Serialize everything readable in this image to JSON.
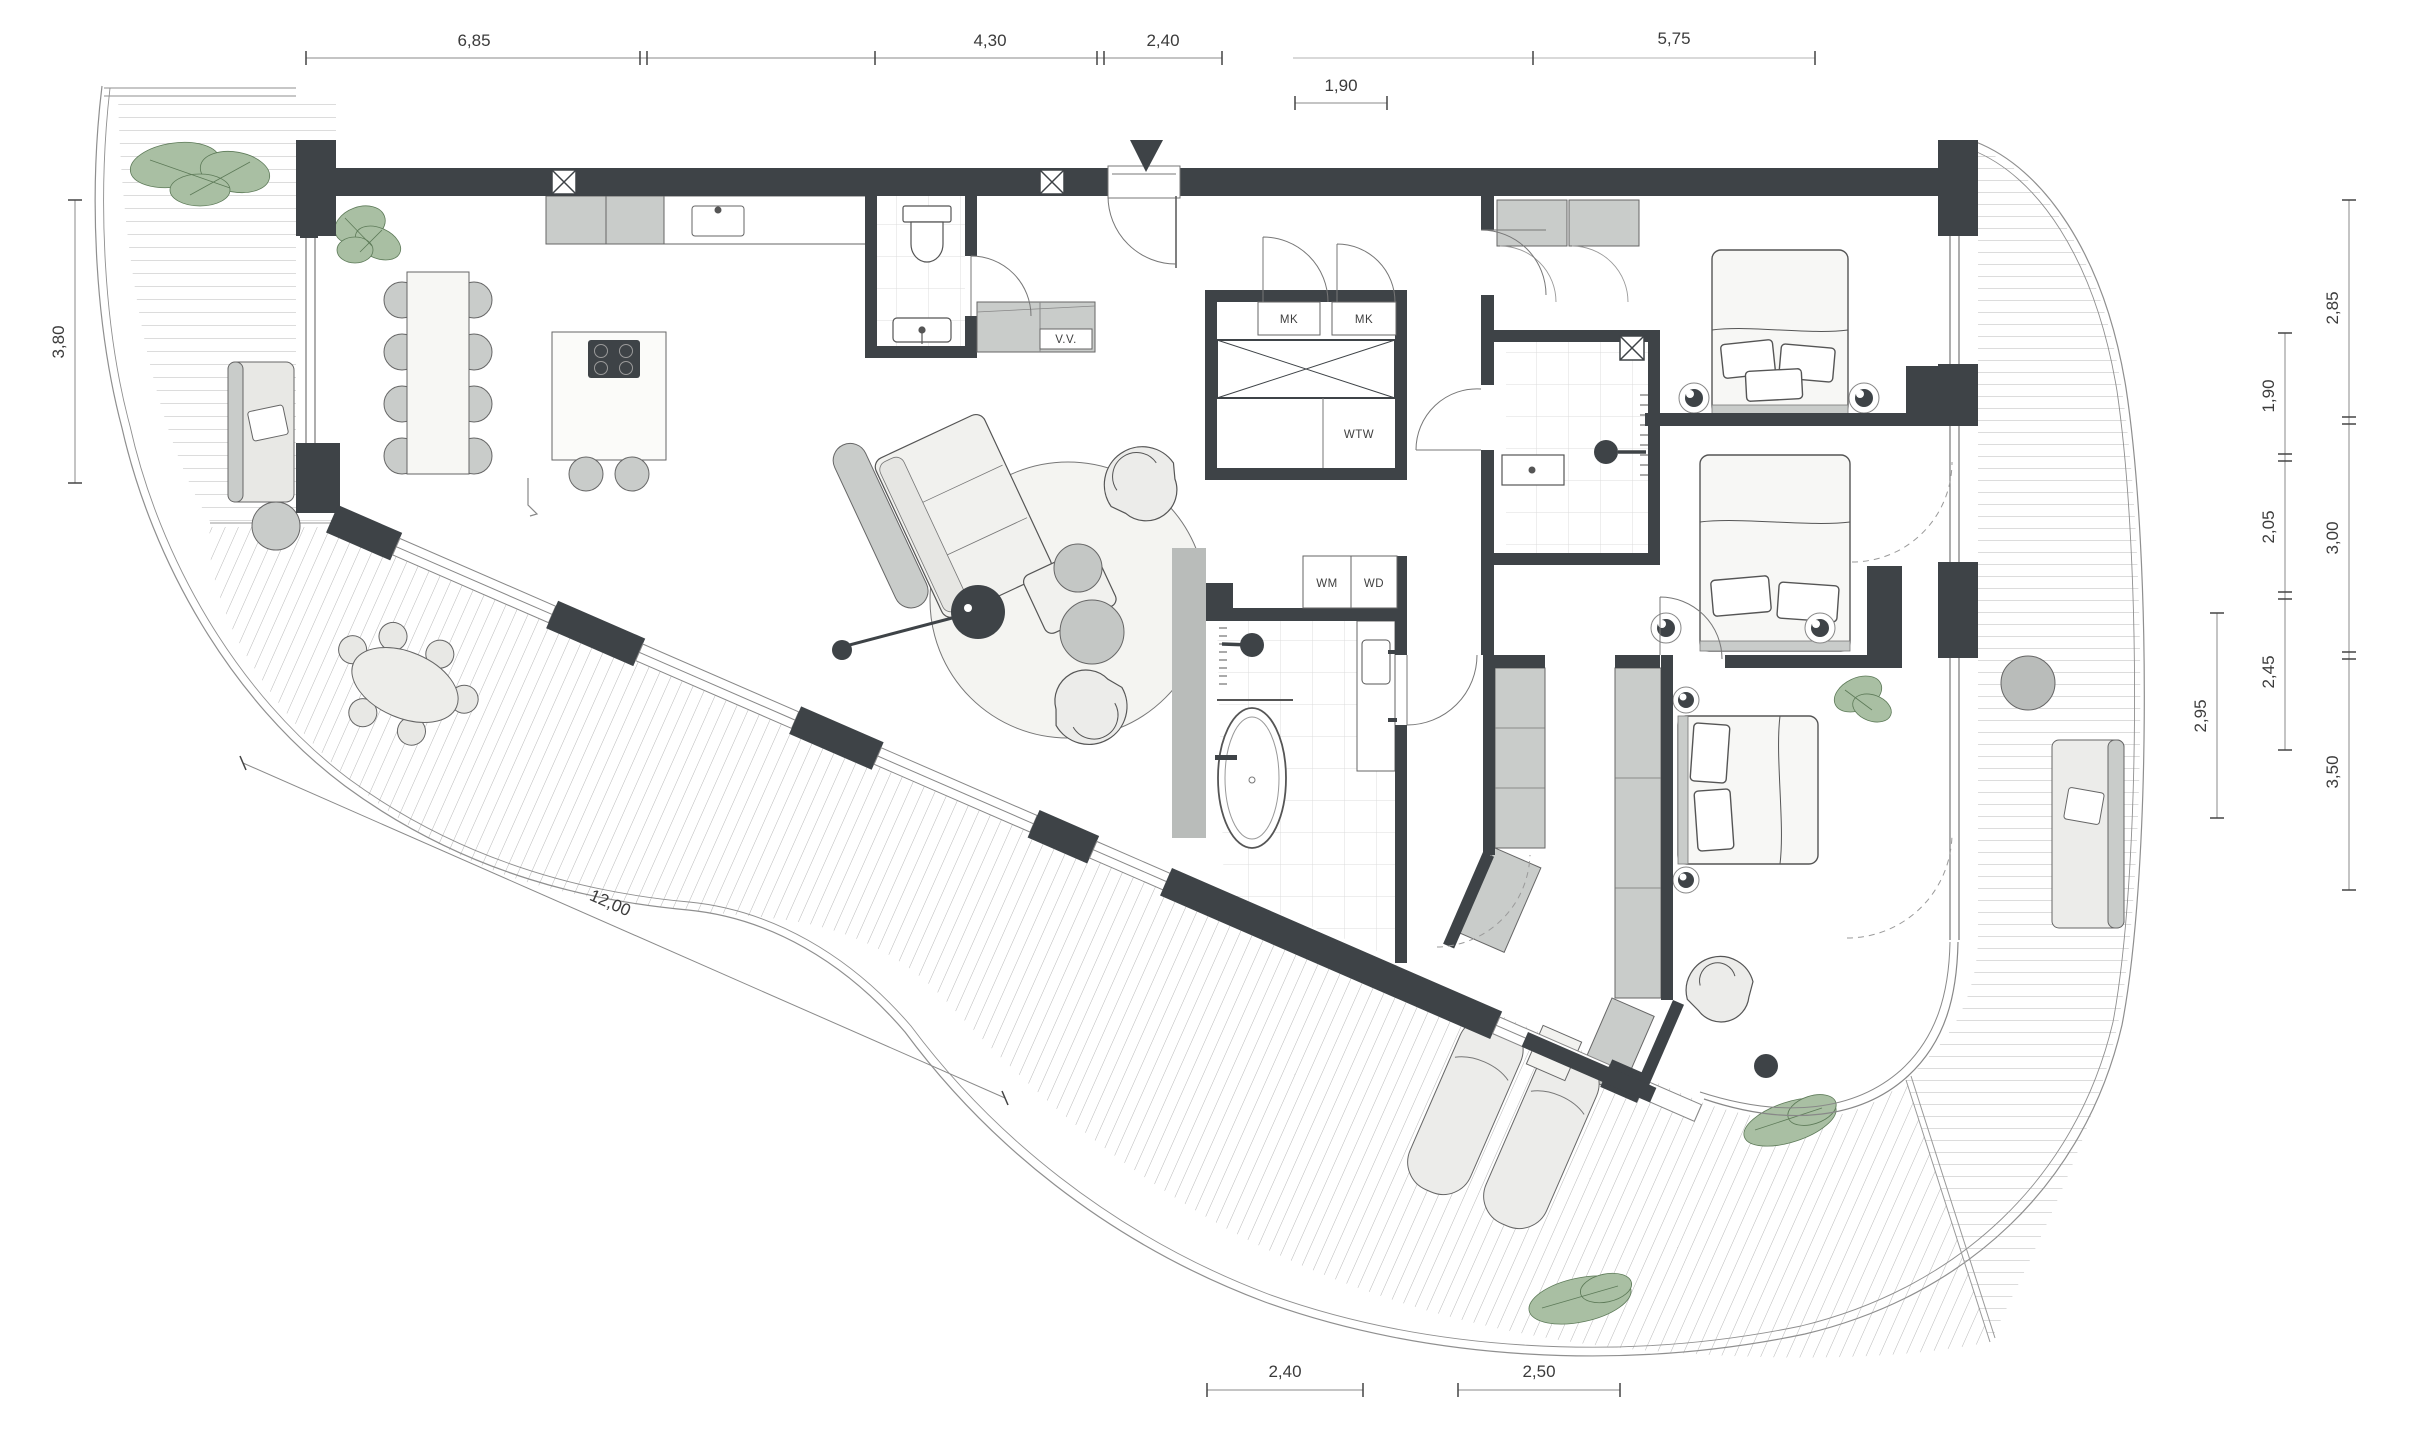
{
  "meta": {
    "type": "architectural-floor-plan",
    "units": "meters"
  },
  "dimensions": {
    "top": [
      "6,85",
      "4,30",
      "2,40",
      "5,75"
    ],
    "top_sub": "1,90",
    "left": "3,80",
    "right_outer": [
      "2,85",
      "3,00",
      "3,50"
    ],
    "right_inner": [
      "1,90",
      "2,05",
      "2,45"
    ],
    "right_detail": "2,95",
    "bottom": [
      "2,40",
      "2,50"
    ],
    "diagonal": "12,00"
  },
  "room_labels": {
    "mk_left": "MK",
    "mk_right": "MK",
    "wtw": "WTW",
    "wm": "WM",
    "wd": "WD",
    "vv": "V.V."
  },
  "colors": {
    "wall": "#3e4347",
    "wall_light": "#b9bcba",
    "furniture_gray": "#c9ccca",
    "furniture_light": "#f1f1ee",
    "plant_green": "#a9bfa3",
    "plant_stroke": "#5d7a58",
    "deck_line": "#a6a6a6",
    "line": "#555555",
    "background": "#ffffff"
  }
}
